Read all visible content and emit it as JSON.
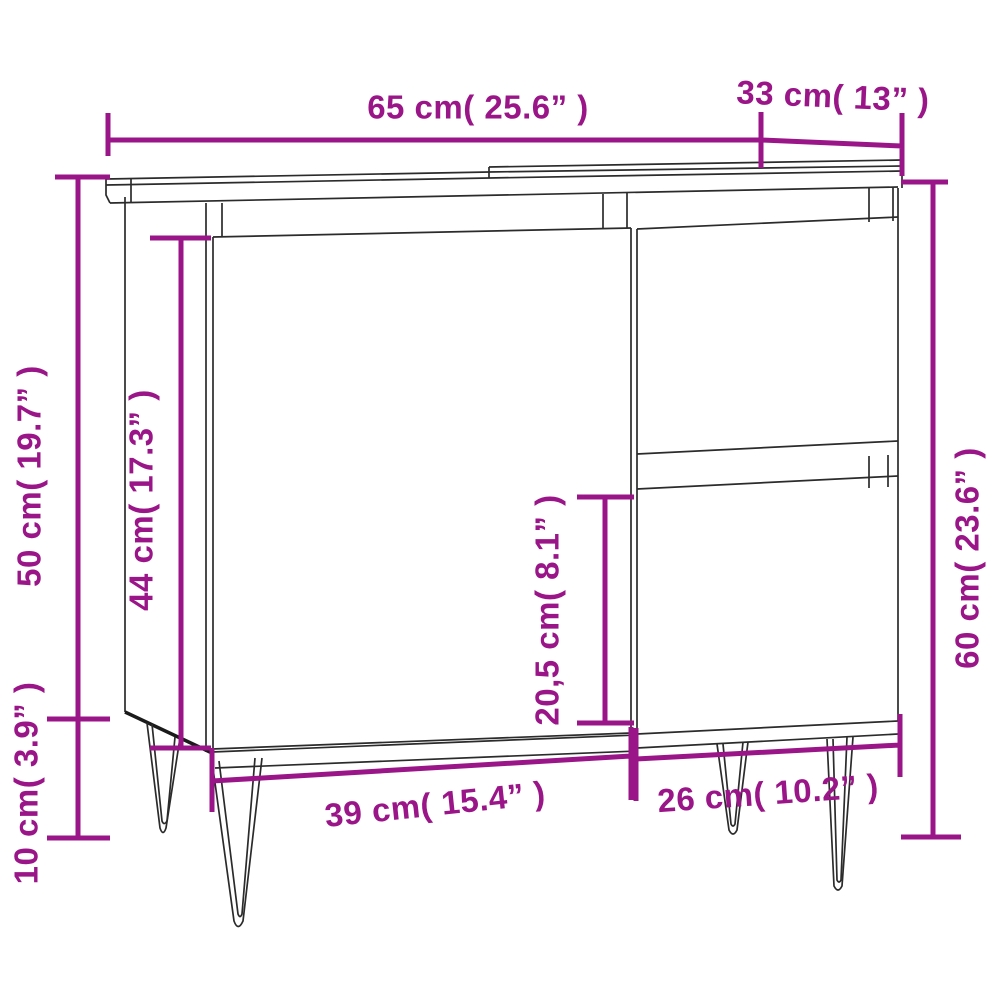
{
  "diagram": {
    "kind": "furniture-dimension-line-drawing",
    "colors": {
      "dimension_accent": "#9a1588",
      "line_art": "#2b2b2b",
      "background": "#ffffff"
    },
    "dimensions": {
      "top_width": {
        "text": "65 cm( 25.6” )"
      },
      "top_depth": {
        "text": "33 cm( 13” )"
      },
      "upper_height": {
        "text": "50 cm( 19.7” )"
      },
      "door_height": {
        "text": "44 cm( 17.3” )"
      },
      "drawer_height": {
        "text": "20,5 cm( 8.1” )"
      },
      "total_height": {
        "text": "60 cm( 23.6” )"
      },
      "door_width": {
        "text": "39 cm( 15.4” )"
      },
      "drawer_width": {
        "text": "26 cm( 10.2” )"
      },
      "leg_height": {
        "text": "10 cm( 3.9” )"
      }
    }
  }
}
